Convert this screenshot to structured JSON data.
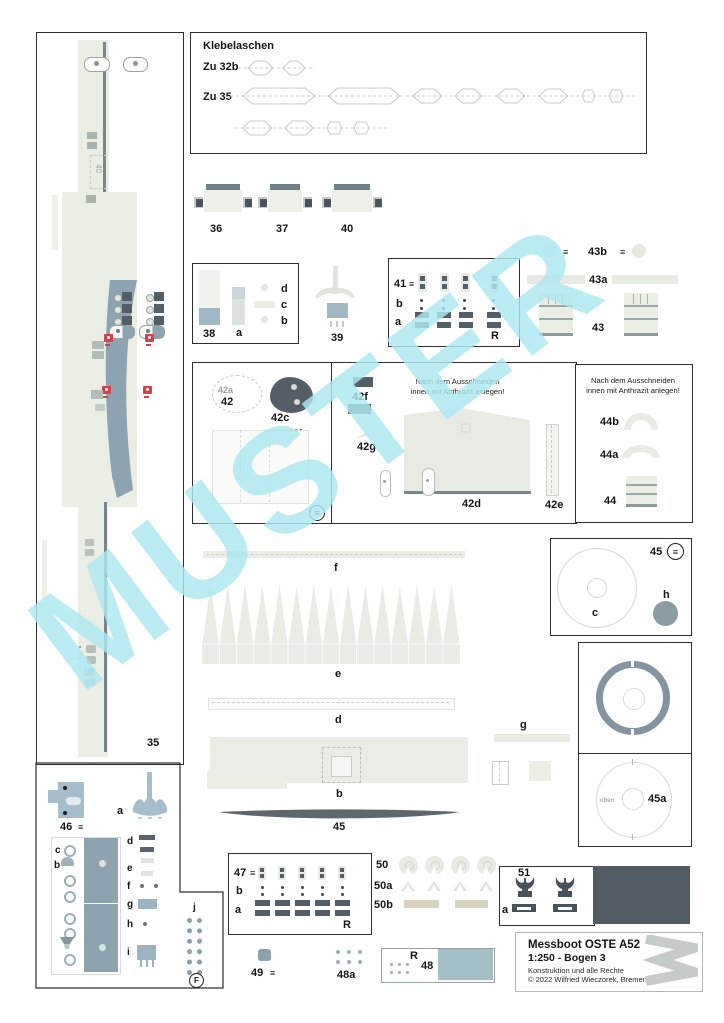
{
  "watermark": {
    "text": "MUSTER"
  },
  "klebelaschen": {
    "title": "Klebelaschen",
    "row1_label": "Zu 32b",
    "row2_label": "Zu 35"
  },
  "winches": {
    "w36": "36",
    "w37": "37",
    "w40": "40"
  },
  "box38": {
    "main": "38",
    "a": "a",
    "b": "b",
    "c": "c",
    "d": "d"
  },
  "p39": {
    "label": "39"
  },
  "box41": {
    "main": "41",
    "fold": "≡",
    "row_b": "b",
    "row_a": "a",
    "corner": "R"
  },
  "g43": {
    "label_b": "43b",
    "label_a": "43a",
    "main": "43",
    "fold_left": "≡",
    "fold_right": "≡"
  },
  "g42": {
    "main": "42",
    "a": "42a",
    "b": "42b",
    "c": "42c",
    "d": "42d",
    "e": "42e",
    "f": "42f",
    "g": "42g",
    "fold": "≡",
    "note_line1": "Nach dem Ausschneiden",
    "note_line2": "innen mit Anthrazit anlegen!"
  },
  "box44": {
    "note_line1": "Nach dem Ausschneiden",
    "note_line2": "innen mit Anthrazit anlegen!",
    "label_b": "44b",
    "label_a": "44a",
    "main": "44"
  },
  "strip35": {
    "label": "35",
    "deck_mark": "40"
  },
  "mid": {
    "f": "f",
    "e": "e",
    "d": "d",
    "b": "b",
    "p45": "45"
  },
  "box45": {
    "main": "45",
    "fold": "≡",
    "c": "c",
    "h": "h"
  },
  "part_g": {
    "label": "g"
  },
  "box45a": {
    "main": "45a",
    "oben": "oben"
  },
  "g46": {
    "main": "46",
    "fold": "≡",
    "a": "a",
    "c": "c",
    "b": "b",
    "d": "d",
    "e": "e",
    "f": "f",
    "g": "g",
    "h": "h",
    "i": "i",
    "j": "j",
    "circle_letter": "F"
  },
  "box47": {
    "main": "47",
    "fold": "≡",
    "row_b": "b",
    "row_a": "a",
    "corner": "R"
  },
  "g50": {
    "l50": "50",
    "l50a": "50a",
    "l50b": "50b"
  },
  "box51": {
    "main": "51",
    "a": "a"
  },
  "g48": {
    "p49": "49",
    "fold49": "≡",
    "p48a": "48a",
    "corner_r": "R",
    "p48": "48"
  },
  "titleblock": {
    "line1": "Messboot OSTE A52",
    "line2": "1:250 - Bogen 3",
    "line3": "Konstruktion und alle Rechte",
    "line4": "© 2022 Wilfried Wieczorek, Bremen"
  },
  "colors": {
    "part_light": "#eaeee4",
    "steel_blue": "#8ca4b2",
    "steel_light": "#a6becb",
    "dark_gray": "#545e66",
    "beige": "#d8d3c0",
    "red": "#d9404a",
    "watermark": "#aee8f1"
  }
}
